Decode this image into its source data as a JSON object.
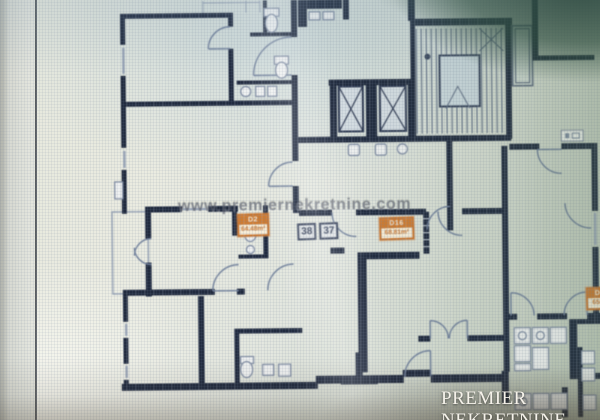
{
  "photo": {
    "watermark_text": "www.premiernekretnine.com",
    "brand_text": "PREMIER NEKRETNINE"
  },
  "floor_plan": {
    "hall_numbers": [
      "38",
      "37"
    ],
    "unit_stamps": [
      {
        "name": "D2",
        "area": "64.48m²"
      },
      {
        "name": "D16",
        "area": "68.81m²"
      },
      {
        "name": "D3",
        "area": "65m²"
      }
    ]
  },
  "colors": {
    "wall_navy": "#212b40",
    "stamp_orange": "#c9732c",
    "paper": "#e7e8de",
    "reflection_green": "#2e4838",
    "brand_white": "#f5f2ea"
  }
}
